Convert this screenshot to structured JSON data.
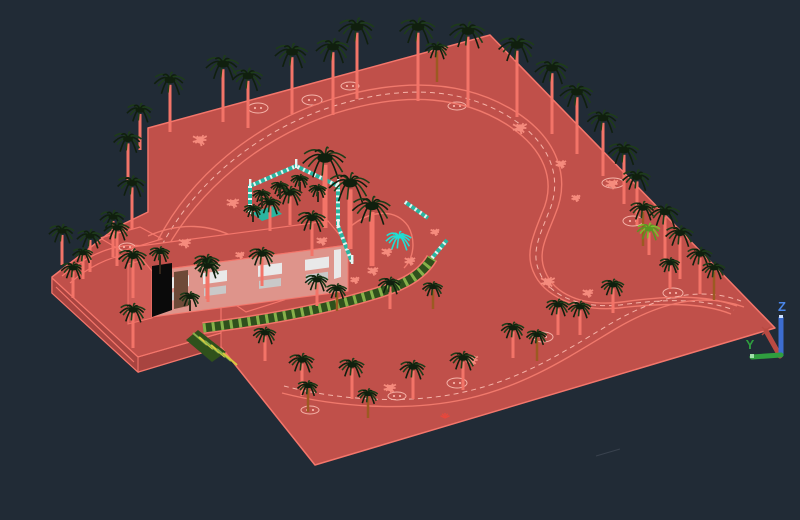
{
  "viewport": {
    "background_color": "#212b36",
    "description": "3D shaded CAD model-space view of a landscape site: red terrain with villa, palm trees, curved paths, pergola and pool courtyard"
  },
  "ucs_icon": {
    "z_label": "Z",
    "y_label": "Y",
    "z_axis_color": "#3d6dd0",
    "y_axis_color": "#2f9e3f",
    "x_axis_color": "#b94a42"
  },
  "palette": {
    "terrain_top": "#c0504a",
    "terrain_side": "#a84440",
    "edge_highlight": "#f4766b",
    "wall_light": "#de948b",
    "annex_wall": "#cf5c55",
    "window_white": "#e9e9e9",
    "window_gray": "#c9c9c9",
    "door_dark": "#0a0a0a",
    "door_brown": "#6e4a38",
    "teal_fence": "#2ab5a0",
    "fence_white": "#e8f5f2",
    "pergola_dark": "#2f511c",
    "pergola_light": "#86b04a",
    "stripe_yellow": "#d8c93e",
    "frond_dark": "#101f0e",
    "frond_mid": "#1e3c19",
    "trunk_salmon": "#f37468",
    "trunk_brown": "#9c5a22",
    "trunk_dark": "#33261a",
    "bush_salmon": "#f58b7d",
    "cyan_plant": "#20dfd4",
    "green_palm_light": "#7cbb2d",
    "green_palm_dark": "#5a9422",
    "road_line": "#f0796c",
    "road_dash": "#f5b3a8",
    "faint_line": "#39424e",
    "sprig_red": "#e8473c"
  },
  "scene": {
    "terrain_silhouette": "490,35 775,328 315,465 221,347 138,372 52,293 52,277 117,227 148,212 148,128",
    "side_bands": [
      "52,278 138,357 138,372 52,293",
      "138,357 221,333 221,347 138,372"
    ],
    "step_lines": [
      "M52,278 L138,357 L221,333",
      "M56,287 L134,362",
      "M221,333 L221,308",
      "M62,276 Q108,238 150,247",
      "M70,283 Q112,247 156,255"
    ],
    "pads": [
      "100,238 140,227 162,239 122,251",
      "224,297 262,286 284,300 246,312"
    ],
    "roads": [
      {
        "d": "M158,240 C 190,178 252,124 332,99 C 412,75 472,84 516,112 C 558,139 571,178 555,215 C 547,236 537,252 545,271 C 554,294 582,307 622,302 C 666,296 704,294 737,306",
        "dash": false
      },
      {
        "d": "M166,250 C 198,192 258,138 336,113 C 410,90 464,98 506,124 C 544,148 557,180 542,213 C 534,234 525,252 533,271 C 543,296 577,312 619,308 C 661,303 701,302 731,314",
        "dash": false
      },
      {
        "d": "M162,245 C 194,185 255,131 334,106 C 411,82 468,91 511,118 C 551,143 564,179 548,214 C 540,235 531,252 539,271 C 548,295 579,309 620,305 C 663,299 702,298 734,310",
        "dash": true
      },
      {
        "d": "M282,393 C 336,407 408,412 466,399 C 524,386 564,360 612,331 C 660,302 702,292 744,307",
        "dash": false
      },
      {
        "d": "M284,386 C 338,400 408,405 464,392 C 522,379 562,353 610,324 C 658,296 700,286 741,301",
        "dash": true
      },
      {
        "d": "M148,236 C 180,222 210,224 236,238",
        "dash": false
      },
      {
        "d": "M350,227 C 370,210 395,208 408,226 C 416,240 414,258 404,268",
        "dash": false
      }
    ],
    "pergola": {
      "d": "M203,328 C 252,322 304,313 346,302 C 390,290 418,282 432,258"
    },
    "teal_segments": [
      "M250,212 L250,186 L296,166 L338,186 L338,226",
      "M338,226 L352,262",
      "M432,258 L447,240",
      "M405,202 L428,218"
    ],
    "fence_posts": [
      [
        250,
        186
      ],
      [
        296,
        166
      ],
      [
        338,
        186
      ],
      [
        338,
        226
      ],
      [
        250,
        212
      ],
      [
        352,
        262
      ]
    ],
    "building": {
      "roof": "152,271 348,245 328,221 132,247",
      "wall": "152,271 348,245 348,291 152,317",
      "wall_slope": 0.1327,
      "window_xs": [
        165,
        203,
        258,
        305
      ],
      "white_door": "334,250 341,249 341,277 334,279",
      "dark_door": "152,266 172,263 172,310 152,317",
      "brown_panel": "174,272 188,270 188,306 174,309",
      "annex": "128,264 152,258 152,318 128,324",
      "pool": "252,213 272,206 282,214 262,221",
      "stripe_patch": "198,330 226,352 212,362 186,340"
    },
    "trees": [
      [
        170,
        80,
        52,
        12,
        "s"
      ],
      [
        223,
        64,
        58,
        13,
        "s"
      ],
      [
        248,
        76,
        52,
        12,
        "s"
      ],
      [
        292,
        52,
        62,
        13,
        "s"
      ],
      [
        333,
        47,
        68,
        13,
        "s"
      ],
      [
        357,
        27,
        72,
        14,
        "s"
      ],
      [
        418,
        27,
        74,
        14,
        "s"
      ],
      [
        468,
        31,
        76,
        14,
        "s"
      ],
      [
        437,
        48,
        34,
        9,
        "b"
      ],
      [
        517,
        45,
        72,
        14,
        "s"
      ],
      [
        552,
        68,
        66,
        13,
        "s"
      ],
      [
        577,
        92,
        62,
        13,
        "s"
      ],
      [
        603,
        118,
        58,
        12,
        "s"
      ],
      [
        624,
        150,
        54,
        12,
        "s"
      ],
      [
        637,
        177,
        48,
        11,
        "s"
      ],
      [
        643,
        208,
        38,
        10,
        "b"
      ],
      [
        665,
        212,
        50,
        12,
        "s"
      ],
      [
        680,
        233,
        46,
        11,
        "s"
      ],
      [
        700,
        254,
        40,
        10,
        "s"
      ],
      [
        714,
        268,
        32,
        9,
        "b"
      ],
      [
        649,
        229,
        26,
        9,
        "g"
      ],
      [
        140,
        110,
        40,
        10,
        "s"
      ],
      [
        128,
        139,
        42,
        11,
        "s"
      ],
      [
        132,
        183,
        46,
        11,
        "s"
      ],
      [
        113,
        217,
        40,
        10,
        "s"
      ],
      [
        62,
        231,
        34,
        10,
        "s"
      ],
      [
        90,
        236,
        36,
        10,
        "s"
      ],
      [
        73,
        268,
        30,
        9,
        "s"
      ],
      [
        117,
        228,
        38,
        10,
        "s"
      ],
      [
        133,
        256,
        42,
        11,
        "s"
      ],
      [
        83,
        253,
        26,
        8,
        "s"
      ],
      [
        160,
        252,
        22,
        8,
        "d"
      ],
      [
        133,
        310,
        38,
        10,
        "s"
      ],
      [
        207,
        261,
        38,
        10,
        "s"
      ],
      [
        325,
        158,
        70,
        17,
        "B"
      ],
      [
        350,
        183,
        66,
        16,
        "B"
      ],
      [
        372,
        206,
        60,
        15,
        "B"
      ],
      [
        312,
        218,
        38,
        11,
        "s"
      ],
      [
        290,
        193,
        32,
        10,
        "s"
      ],
      [
        270,
        203,
        28,
        9,
        "s"
      ],
      [
        262,
        194,
        14,
        7,
        "d"
      ],
      [
        280,
        186,
        13,
        7,
        "d"
      ],
      [
        300,
        179,
        13,
        7,
        "d"
      ],
      [
        318,
        189,
        13,
        7,
        "d"
      ],
      [
        253,
        209,
        13,
        7,
        "d"
      ],
      [
        190,
        297,
        14,
        8,
        "d"
      ],
      [
        208,
        266,
        36,
        10,
        "s"
      ],
      [
        262,
        254,
        32,
        10,
        "s"
      ],
      [
        317,
        280,
        26,
        9,
        "s"
      ],
      [
        337,
        289,
        22,
        8,
        "b"
      ],
      [
        390,
        283,
        26,
        9,
        "s"
      ],
      [
        433,
        287,
        22,
        8,
        "b"
      ],
      [
        302,
        360,
        36,
        10,
        "s"
      ],
      [
        308,
        386,
        26,
        8,
        "b"
      ],
      [
        352,
        365,
        34,
        10,
        "s"
      ],
      [
        368,
        394,
        24,
        8,
        "b"
      ],
      [
        413,
        367,
        32,
        10,
        "s"
      ],
      [
        463,
        358,
        32,
        10,
        "s"
      ],
      [
        513,
        328,
        30,
        9,
        "s"
      ],
      [
        537,
        335,
        26,
        8,
        "b"
      ],
      [
        558,
        305,
        30,
        9,
        "s"
      ],
      [
        580,
        307,
        28,
        9,
        "s"
      ],
      [
        613,
        285,
        28,
        9,
        "s"
      ],
      [
        670,
        263,
        26,
        8,
        "s"
      ],
      [
        265,
        333,
        28,
        9,
        "s"
      ],
      [
        399,
        238,
        0,
        10,
        "c"
      ]
    ],
    "bushes": [
      [
        200,
        140,
        8
      ],
      [
        233,
        203,
        7
      ],
      [
        185,
        243,
        7
      ],
      [
        520,
        128,
        8
      ],
      [
        561,
        164,
        6
      ],
      [
        612,
        184,
        7
      ],
      [
        576,
        198,
        5
      ],
      [
        548,
        282,
        8
      ],
      [
        588,
        293,
        6
      ],
      [
        472,
        360,
        7
      ],
      [
        390,
        388,
        7
      ],
      [
        410,
        261,
        6
      ],
      [
        373,
        271,
        6
      ],
      [
        387,
        252,
        6
      ],
      [
        355,
        280,
        5
      ],
      [
        322,
        241,
        6
      ],
      [
        435,
        232,
        5
      ],
      [
        240,
        255,
        5
      ]
    ],
    "ovals": [
      [
        258,
        108,
        10,
        5
      ],
      [
        312,
        100,
        10,
        5
      ],
      [
        350,
        86,
        9,
        4
      ],
      [
        457,
        106,
        9,
        4
      ],
      [
        613,
        183,
        11,
        5
      ],
      [
        633,
        221,
        10,
        5
      ],
      [
        543,
        337,
        10,
        5
      ],
      [
        673,
        293,
        10,
        5
      ],
      [
        457,
        383,
        10,
        5
      ],
      [
        397,
        396,
        9,
        4
      ],
      [
        310,
        410,
        9,
        4
      ],
      [
        127,
        247,
        8,
        4
      ]
    ],
    "sprigs": [
      [
        445,
        418
      ]
    ],
    "faint_line": "M596,456 L620,449",
    "ucs": {
      "origin": [
        780,
        356
      ],
      "z_top": [
        781,
        317
      ],
      "y_end": [
        752,
        357
      ],
      "x_end": [
        766,
        331
      ],
      "z_label_pos": [
        782,
        311
      ],
      "y_label_pos": [
        750,
        349
      ]
    }
  }
}
